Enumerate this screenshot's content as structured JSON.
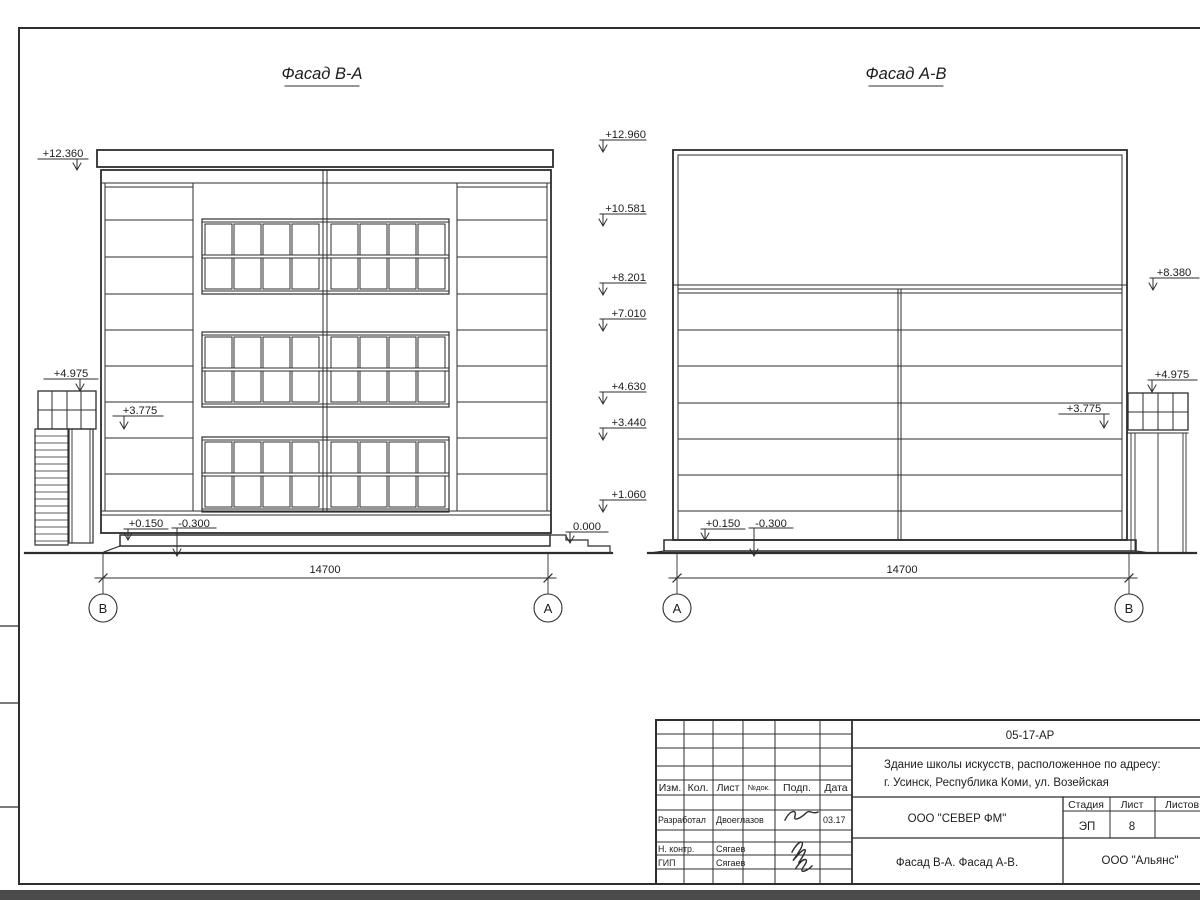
{
  "drawing": {
    "facade_left": {
      "title": "Фасад В-А",
      "dim": "14700",
      "axis_left": "В",
      "axis_right": "А",
      "marks": {
        "top": "+12.360",
        "tower": "+4.975",
        "mid": "+3.775",
        "plinth": "+0.150",
        "below_ground": "-0.300",
        "entry": "0.000"
      }
    },
    "levels": [
      "+12.960",
      "+10.581",
      "+8.201",
      "+7.010",
      "+4.630",
      "+3.440",
      "+1.060"
    ],
    "facade_right": {
      "title": "Фасад А-В",
      "dim": "14700",
      "axis_left": "А",
      "axis_right": "В",
      "marks": {
        "roof": "+8.380",
        "tower": "+4.975",
        "mid": "+3.775",
        "plinth": "+0.150",
        "below_ground": "-0.300"
      }
    }
  },
  "title_block": {
    "doc_number": "05-17-АР",
    "project_address_line1": "Здание школы искусств, расположенное по адресу:",
    "project_address_line2": "г. Усинск, Республика Коми, ул. Возейская",
    "header": {
      "izm": "Изм.",
      "kol": "Кол.",
      "list": "Лист",
      "ndok": "№док.",
      "podp": "Подп.",
      "data": "Дата"
    },
    "signers": [
      {
        "role": "Разработал",
        "name": "Двоеглазов",
        "date": "03.17"
      },
      {
        "role": "Н. контр.",
        "name": "Сягаев",
        "date": ""
      },
      {
        "role": "ГИП",
        "name": "Сягаев",
        "date": ""
      }
    ],
    "company": "ООО \"СЕВЕР ФМ\"",
    "stage_label": "Стадия",
    "sheet_label": "Лист",
    "sheets_label": "Листов",
    "stage_value": "ЭП",
    "sheet_value": "8",
    "content_title": "Фасад В-А. Фасад А-В.",
    "contractor": "ООО \"Альянс\""
  }
}
